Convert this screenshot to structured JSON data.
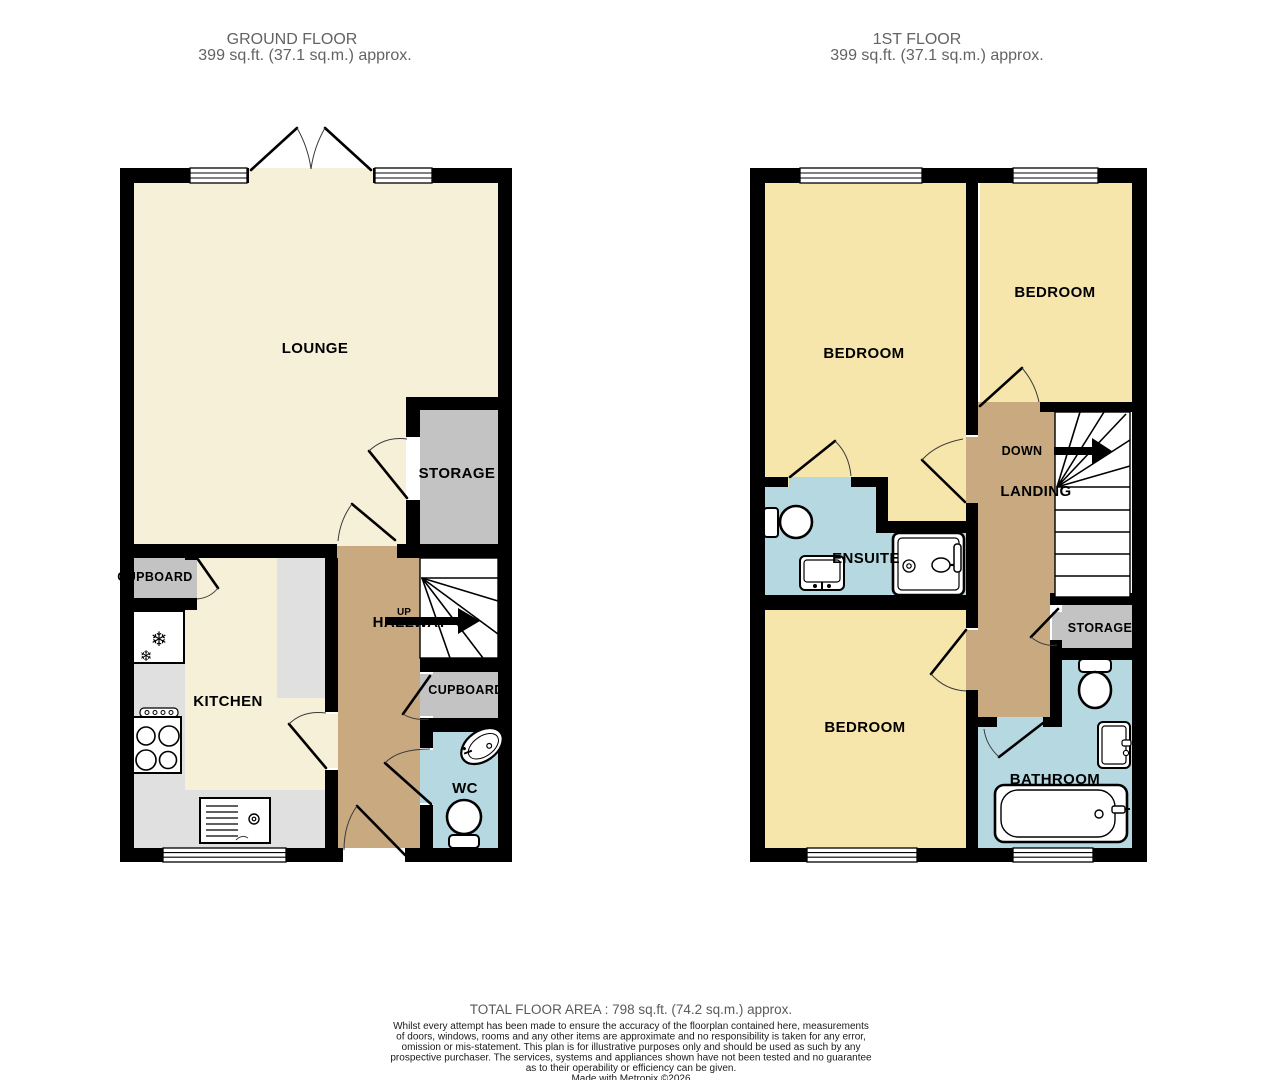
{
  "header": {
    "ground_floor": {
      "title": "GROUND FLOOR",
      "area": "399 sq.ft. (37.1 sq.m.) approx."
    },
    "first_floor": {
      "title": "1ST FLOOR",
      "area": "399 sq.ft. (37.1 sq.m.) approx."
    }
  },
  "ground_floor": {
    "rooms": {
      "lounge": "LOUNGE",
      "storage": "STORAGE",
      "kitchen": "KITCHEN",
      "hallway": "HALLWAY",
      "cupboard_left": "CUPBOARD",
      "cupboard_right": "CUPBOARD",
      "wc": "WC"
    },
    "stairs_direction": "UP"
  },
  "first_floor": {
    "rooms": {
      "bedroom_large": "BEDROOM",
      "bedroom_top_right": "BEDROOM",
      "bedroom_bottom": "BEDROOM",
      "ensuite": "ENSUITE",
      "landing": "LANDING",
      "storage": "STORAGE",
      "bathroom": "BATHROOM"
    },
    "stairs_direction": "DOWN"
  },
  "footer": {
    "total_area": "TOTAL FLOOR AREA : 798 sq.ft. (74.2 sq.m.) approx.",
    "disclaimer_lines": [
      "Whilst every attempt has been made to ensure the accuracy of the floorplan contained here, measurements",
      "of doors, windows, rooms and any other items are approximate and no responsibility is taken for any error,",
      "omission or mis-statement. This plan is for illustrative purposes only and should be used as such by any",
      "prospective purchaser. The services, systems and appliances shown have not been tested and no guarantee",
      "as to their operability or efficiency can be given."
    ],
    "credit": "Made with Metropix ©2026"
  },
  "colors": {
    "wall": "#000000",
    "lounge_cream": "#F7F0D8",
    "bedroom_yellow": "#F7E6AC",
    "hall_tan": "#C9A97F",
    "wet_blue": "#B5D8E1",
    "room_gray": "#C3C3C3",
    "counter_gray": "#E0E0E0",
    "stairs_white": "#FFFFFF",
    "title_gray": "#636363"
  }
}
